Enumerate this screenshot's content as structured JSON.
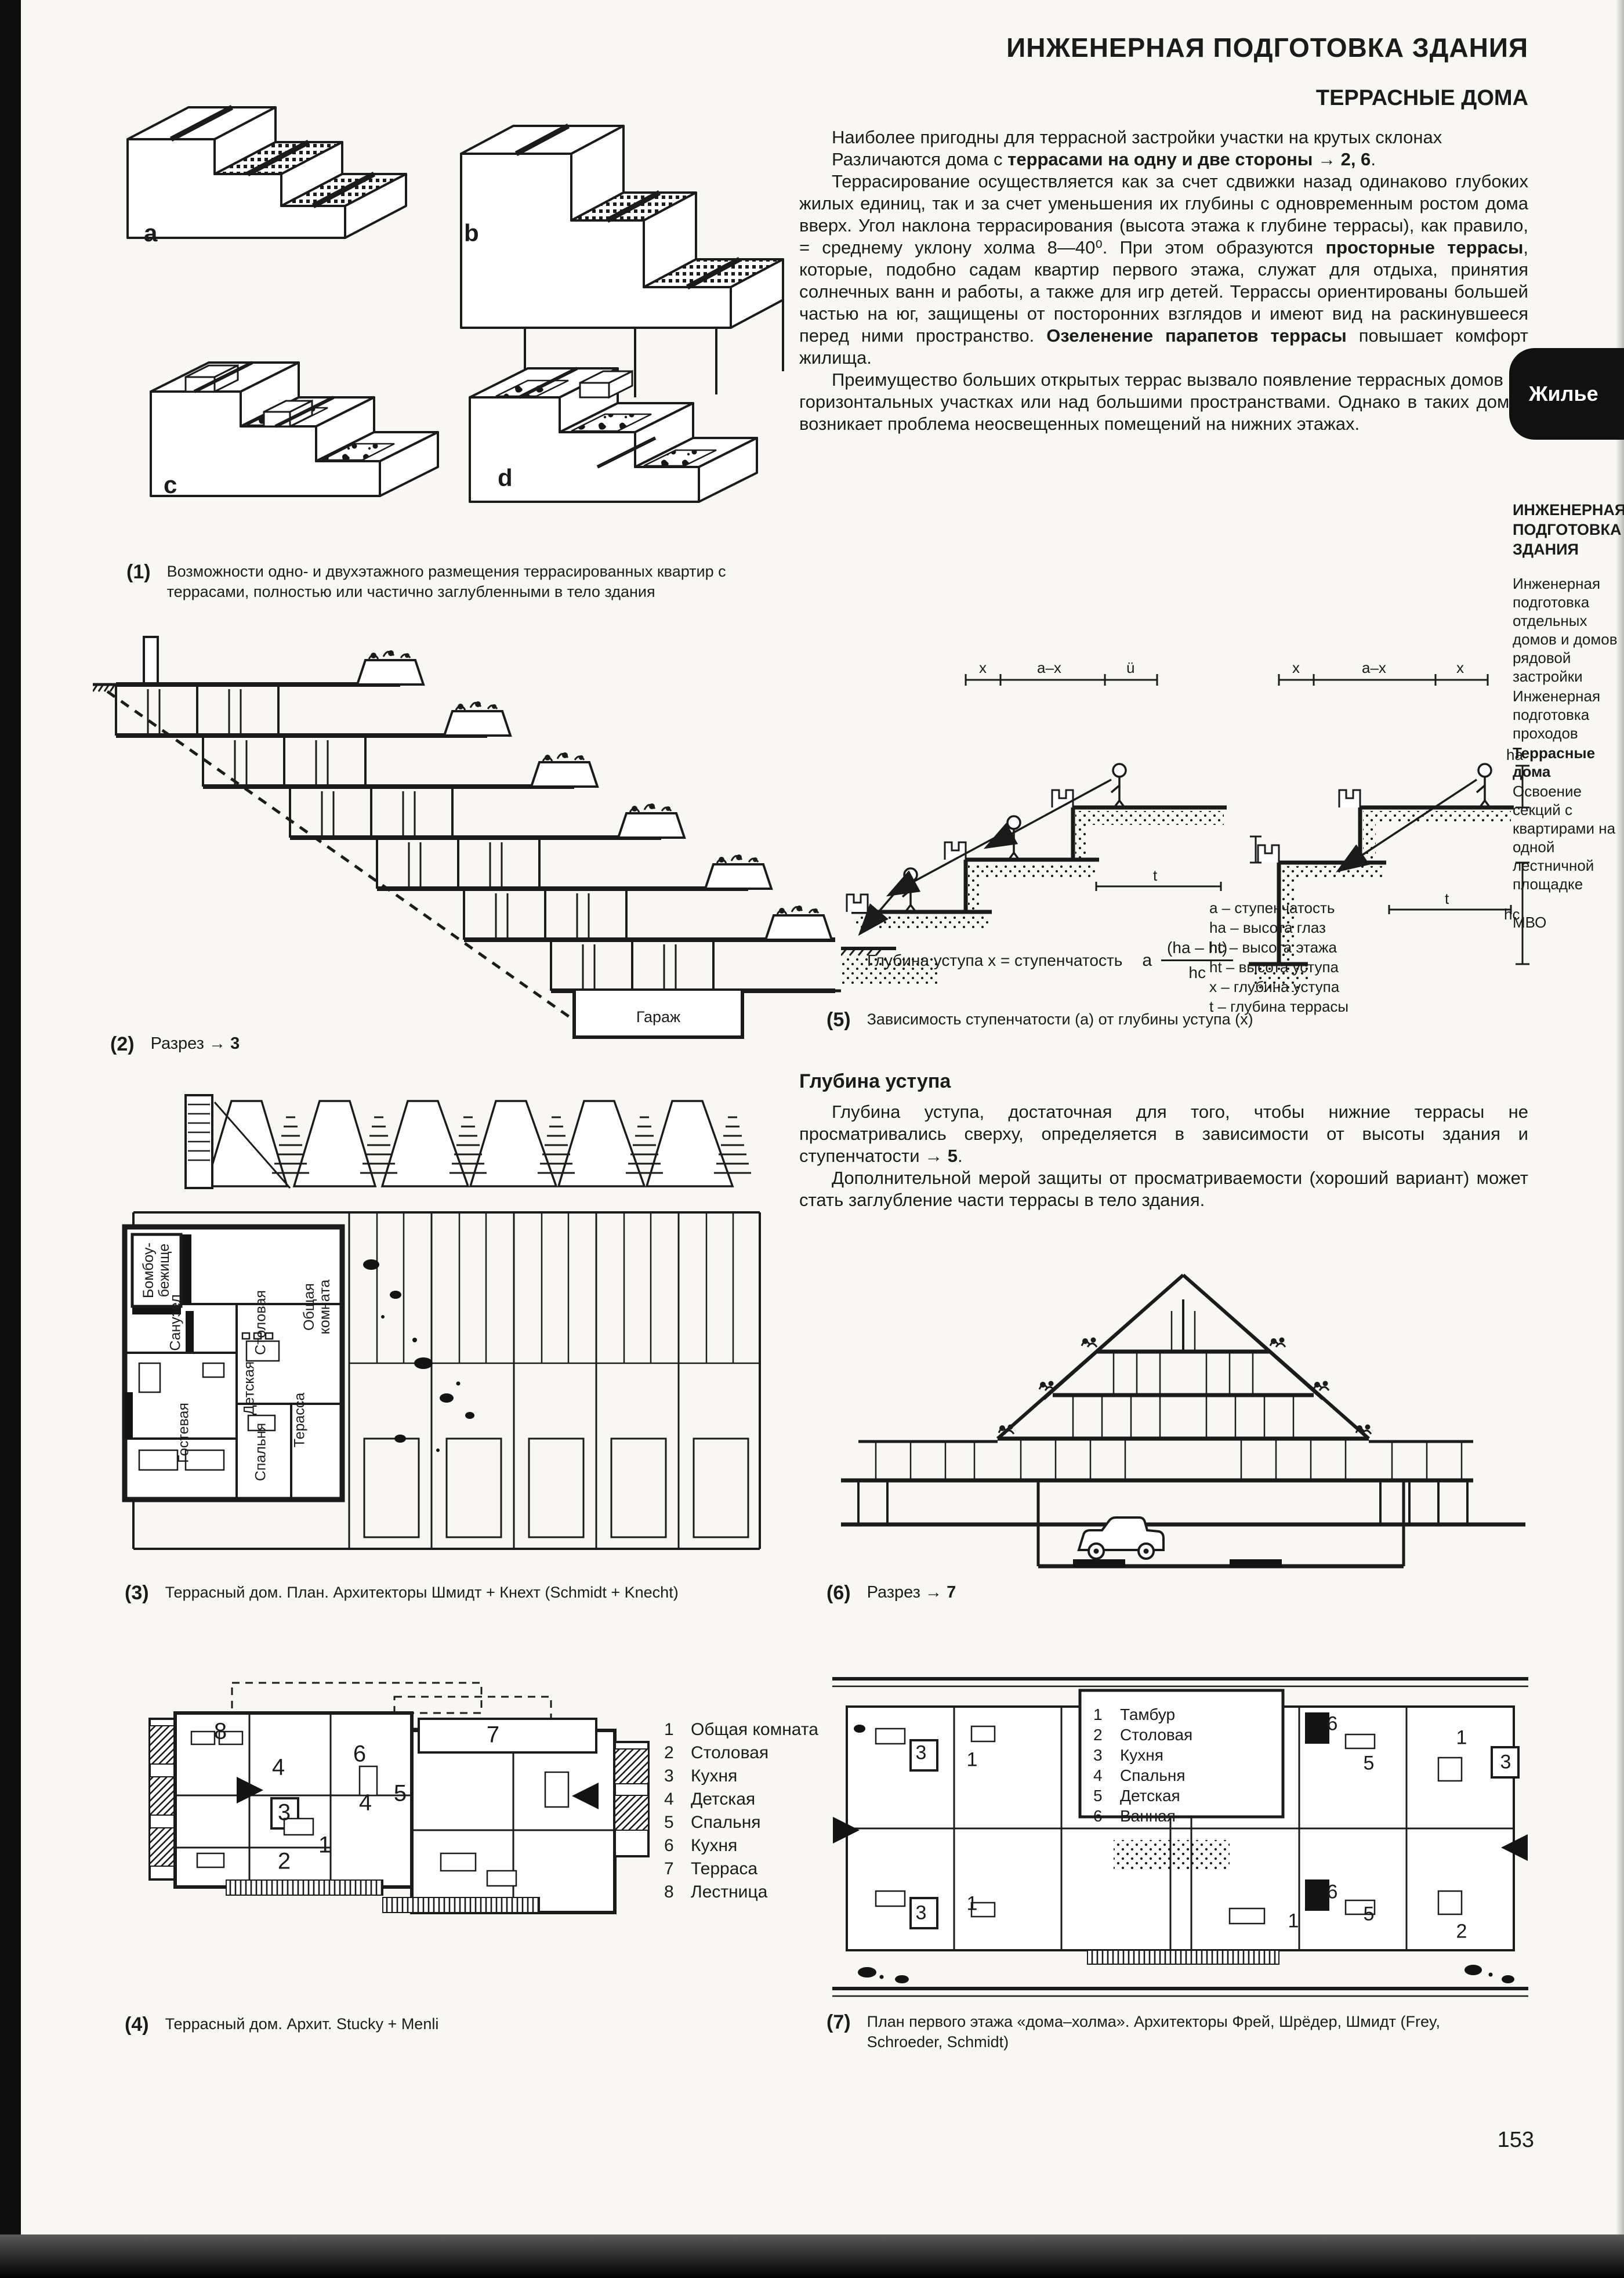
{
  "page": {
    "number": "153"
  },
  "tab": {
    "label": "Жилье"
  },
  "header": {
    "title": "ИНЖЕНЕРНАЯ ПОДГОТОВКА ЗДАНИЯ",
    "subtitle": "ТЕРРАСНЫЕ ДОМА"
  },
  "intro": {
    "p1": "Наиболее пригодны для террасной застройки участки на крутых склонах",
    "p2a": "Различаются дома с ",
    "p2b": "террасами на одну и две стороны → 2, 6",
    "p2c": ".",
    "p3a": "Террасирование осуществляется как за счет сдвижки назад одинаково глубоких жилых единиц, так и за счет уменьшения их глубины с одновременным ростом дома вверх. Угол наклона террасирования (высота этажа к глубине террасы), как правило, = среднему уклону холма 8—40⁰. При этом образуются ",
    "p3b": "просторные террасы",
    "p3c": ", которые, подобно садам квартир первого этажа, служат для отдыха, принятия солнечных ванн и работы, а также для игр детей. Террассы ориентированы большей частью на юг, защищены от посторонних взглядов и имеют вид на раскинувшееся перед ними пространство. ",
    "p3d": "Озеленение парапетов террасы",
    "p3e": " повышает комфорт жилища.",
    "p4": "Преимущество больших открытых террас вызвало появление террасных домов на горизонтальных участках или над большими пространствами. Однако в таких домах возникает проблема неосвещенных помещений на нижних этажах."
  },
  "depth": {
    "heading": "Глубина  уступа",
    "p1a": "Глубина уступа, достаточная для того, чтобы нижние террасы не просматривались сверху, определяется в зависимости от высоты здания и ступенчатости → ",
    "p1b": "5",
    "p1c": ".",
    "p2": "Дополнительной мерой защиты от просматриваемости (хороший вариант) может стать заглубление части террасы в тело здания."
  },
  "sidebar": {
    "heading": "ИНЖЕНЕРНАЯ ПОДГОТОВКА ЗДАНИЯ",
    "item1": "Инженерная подготовка отдельных домов и домов рядовой застройки",
    "item2": "Инженерная подготовка проходов",
    "item3": "Террасные дома",
    "item4": "Освоение секций с квартирами на одной лестничной площадке",
    "footer": "МВО"
  },
  "fig1": {
    "a": "a",
    "b": "b",
    "c": "c",
    "d": "d"
  },
  "fig2": {
    "garage": "Гараж"
  },
  "fig3": {
    "rooms": {
      "shelter": "Бомбоу­бежище",
      "bath": "Санузел",
      "dining": "Столовая",
      "living": "Общая комната",
      "child": "Детская",
      "guest": "Гостевая",
      "bed": "Спальня",
      "terrace": "Терасса"
    }
  },
  "fig5": {
    "dims": {
      "x1": "x",
      "ax1": "a–x",
      "u": "ü",
      "x2": "x",
      "ax2": "a–x",
      "x3": "x",
      "ha": "ha",
      "hc": "hc",
      "t1": "t",
      "t2": "t"
    },
    "legend": [
      "а – ступенчатость",
      "ha – высота глаз",
      "hc – высота этажа",
      "ht – высота уступа",
      "х – глубина уступа",
      "t – глубина террасы"
    ],
    "formula": {
      "lhs": "Глубина уступа х = ступенчатость",
      "a": "а",
      "num": "(ha – ht)",
      "den": "hc"
    }
  },
  "captions": {
    "c1": {
      "n": "(1)",
      "text": "Возможности одно- и двухэтажного размещения террасированных квартир с террасами, полностью или частично заглубленными в тело здания"
    },
    "c2": {
      "n": "(2)",
      "pre": "Разрез → ",
      "ref": "3"
    },
    "c3": {
      "n": "(3)",
      "text": "Террасный дом. План. Архитекторы Шмидт + Кнехт (Schmidt + Knecht)"
    },
    "c4": {
      "n": "(4)",
      "text": "Террасный дом. Архит. Stucky + Menli"
    },
    "c5": {
      "n": "(5)",
      "text": "Зависимость ступенчатости (а) от глубины уступа (х)"
    },
    "c6": {
      "n": "(6)",
      "pre": "Разрез → ",
      "ref": "7"
    },
    "c7": {
      "n": "(7)",
      "text": "План первого этажа «дома–холма». Архитекторы Фрей, Шрёдер, Шмидт (Frey, Schroeder, Schmidt)"
    }
  },
  "fig4": {
    "legend": [
      [
        "1",
        "Общая комната"
      ],
      [
        "2",
        "Столовая"
      ],
      [
        "3",
        "Кухня"
      ],
      [
        "4",
        "Детская"
      ],
      [
        "5",
        "Спальня"
      ],
      [
        "6",
        "Кухня"
      ],
      [
        "7",
        "Терраса"
      ],
      [
        "8",
        "Лестница"
      ]
    ],
    "numbers": [
      "8",
      "6",
      "4",
      "3",
      "5",
      "4",
      "1",
      "2",
      "7"
    ]
  },
  "fig7": {
    "legend": [
      [
        "1",
        "Тамбур"
      ],
      [
        "2",
        "Столовая"
      ],
      [
        "3",
        "Кухня"
      ],
      [
        "4",
        "Спальня"
      ],
      [
        "5",
        "Детская"
      ],
      [
        "6",
        "Ванная"
      ]
    ],
    "numbers": [
      "3",
      "1",
      "6",
      "5",
      "1",
      "3",
      "3",
      "1",
      "5",
      "2",
      "6",
      "1"
    ]
  }
}
